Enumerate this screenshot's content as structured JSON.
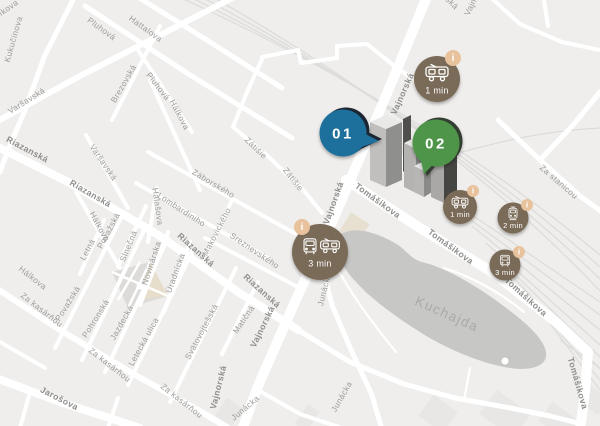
{
  "canvas": {
    "width": 600,
    "height": 426
  },
  "colors": {
    "background": "#efeeec",
    "road": "#ffffff",
    "railway": "#dcdcda",
    "water": "#c7c7c5",
    "marker_brown": "#7a6a58",
    "badge_tan": "#e8c29c",
    "bubble_blue": "#1f6f9b",
    "bubble_blue_shadow": "#1b2630",
    "bubble_green": "#4f9549",
    "bubble_green_shadow": "#333d31",
    "street_label": "#9c9c9a",
    "street_label_major": "#8e8e8c",
    "water_label_color": "#a9a9a7"
  },
  "water_label": {
    "text": "Kuchajda"
  },
  "street_labels": [
    {
      "t": "íkova",
      "x": 10,
      "y": 10,
      "r": -35
    },
    {
      "t": "Kukučínova",
      "x": 16,
      "y": 40,
      "r": -74
    },
    {
      "t": "Varšavská",
      "x": 28,
      "y": 103,
      "r": -32
    },
    {
      "t": "Pluhová",
      "x": 100,
      "y": 31,
      "r": 36
    },
    {
      "t": "Hattalova",
      "x": 144,
      "y": 31,
      "r": 36
    },
    {
      "t": "Brezovská",
      "x": 126,
      "y": 85,
      "r": -60
    },
    {
      "t": "Pluhová",
      "x": 156,
      "y": 88,
      "r": 52
    },
    {
      "t": "Hálkova",
      "x": 177,
      "y": 116,
      "r": 62
    },
    {
      "t": "Riazanská",
      "x": 26,
      "y": 152,
      "r": 28,
      "b": true
    },
    {
      "t": "Varšavská",
      "x": 101,
      "y": 164,
      "r": 56
    },
    {
      "t": "Riazanská",
      "x": 89,
      "y": 196,
      "r": 30,
      "b": true
    },
    {
      "t": "Hálkova",
      "x": 97,
      "y": 228,
      "r": 62
    },
    {
      "t": "Halašova",
      "x": 155,
      "y": 207,
      "r": 82
    },
    {
      "t": "Lombardiniho",
      "x": 180,
      "y": 212,
      "r": 33
    },
    {
      "t": "Záborského",
      "x": 212,
      "y": 186,
      "r": 31
    },
    {
      "t": "Zátišie",
      "x": 254,
      "y": 150,
      "r": 44
    },
    {
      "t": "Zátišie",
      "x": 291,
      "y": 181,
      "r": 52
    },
    {
      "t": "Makovického",
      "x": 219,
      "y": 233,
      "r": -63
    },
    {
      "t": "Sreznevského",
      "x": 253,
      "y": 253,
      "r": 34
    },
    {
      "t": "Novinárska",
      "x": 154,
      "y": 264,
      "r": -72
    },
    {
      "t": "Úradnícka",
      "x": 178,
      "y": 274,
      "r": -70
    },
    {
      "t": "Slnečná",
      "x": 131,
      "y": 247,
      "r": -68
    },
    {
      "t": "Letná",
      "x": 90,
      "y": 251,
      "r": -62
    },
    {
      "t": "Považská",
      "x": 111,
      "y": 232,
      "r": -62
    },
    {
      "t": "Považská",
      "x": 70,
      "y": 305,
      "r": -58
    },
    {
      "t": "Hálkova",
      "x": 31,
      "y": 280,
      "r": 38
    },
    {
      "t": "Za kasárňou",
      "x": 40,
      "y": 312,
      "r": 38
    },
    {
      "t": "Pohronská",
      "x": 98,
      "y": 320,
      "r": -58
    },
    {
      "t": "Jazdecká",
      "x": 124,
      "y": 324,
      "r": -61
    },
    {
      "t": "Letecká ulica",
      "x": 146,
      "y": 343,
      "r": -61
    },
    {
      "t": "Svätovojtešská",
      "x": 204,
      "y": 333,
      "r": -62
    },
    {
      "t": "Matičná",
      "x": 246,
      "y": 321,
      "r": -56
    },
    {
      "t": "Za kasárňou",
      "x": 108,
      "y": 367,
      "r": 38
    },
    {
      "t": "Za kasárňou",
      "x": 180,
      "y": 403,
      "r": 38
    },
    {
      "t": "Jarošova",
      "x": 58,
      "y": 401,
      "r": 27,
      "b": true
    },
    {
      "t": "Riazanská",
      "x": 194,
      "y": 252,
      "r": 42,
      "b": true
    },
    {
      "t": "Riazanská",
      "x": 260,
      "y": 293,
      "r": 42,
      "b": true
    },
    {
      "t": "Vajnorská",
      "x": 265,
      "y": 328,
      "r": -64,
      "b": true
    },
    {
      "t": "Vajnorská",
      "x": 221,
      "y": 388,
      "r": -76,
      "b": true
    },
    {
      "t": "Vajnorská",
      "x": 336,
      "y": 204,
      "r": -70,
      "b": true
    },
    {
      "t": "Vajnorská",
      "x": 405,
      "y": 95,
      "r": -66,
      "b": true
    },
    {
      "t": "Junácka",
      "x": 327,
      "y": 290,
      "r": -76
    },
    {
      "t": "Junácka",
      "x": 247,
      "y": 410,
      "r": -40
    },
    {
      "t": "Junácka",
      "x": 344,
      "y": 398,
      "r": -60
    },
    {
      "t": "Tomášikova",
      "x": 376,
      "y": 203,
      "r": 36,
      "b": true
    },
    {
      "t": "Tomášikova",
      "x": 449,
      "y": 249,
      "r": 36,
      "b": true
    },
    {
      "t": "Tomášikova",
      "x": 524,
      "y": 299,
      "r": 42,
      "b": true
    },
    {
      "t": "Tomášikova",
      "x": 575,
      "y": 384,
      "r": 74,
      "b": true
    },
    {
      "t": "Za stanicou",
      "x": 557,
      "y": 184,
      "r": 41
    },
    {
      "t": "ská",
      "x": 450,
      "y": 5,
      "r": 45
    },
    {
      "t": "Vajno",
      "x": 474,
      "y": 6,
      "r": -64
    }
  ],
  "property_markers": [
    {
      "label": "01",
      "color": "#1f6f9b",
      "shadow": "#1b2630",
      "x": 343,
      "y": 133,
      "tail": "right"
    },
    {
      "label": "02",
      "color": "#4f9549",
      "shadow": "#333d31",
      "x": 436,
      "y": 143,
      "tail": "down-left"
    }
  ],
  "transit_markers": [
    {
      "label": "1 min",
      "icons": [
        "tram-side-icon"
      ],
      "x": 437,
      "y": 79,
      "r": 23,
      "badge": {
        "x": 453,
        "y": 58,
        "r": 8
      },
      "badge_label": "i"
    },
    {
      "label": "1 min",
      "icons": [
        "tram-side-icon"
      ],
      "x": 460,
      "y": 207,
      "r": 17,
      "badge": {
        "x": 473,
        "y": 191,
        "r": 6
      },
      "badge_label": "i"
    },
    {
      "label": "2 min",
      "icons": [
        "train-front-icon"
      ],
      "x": 513,
      "y": 218,
      "r": 15.5,
      "badge": {
        "x": 527,
        "y": 205,
        "r": 6
      },
      "badge_label": "i"
    },
    {
      "label": "3 min",
      "icons": [
        "bus-front-icon"
      ],
      "x": 505,
      "y": 265,
      "r": 15.5,
      "badge": {
        "x": 519,
        "y": 252,
        "r": 6
      },
      "badge_label": "i"
    },
    {
      "label": "3 min",
      "icons": [
        "bus-front-icon",
        "tram-side-icon"
      ],
      "x": 320,
      "y": 252,
      "r": 28,
      "badge": {
        "x": 302,
        "y": 227,
        "r": 8
      },
      "badge_label": "i"
    }
  ]
}
